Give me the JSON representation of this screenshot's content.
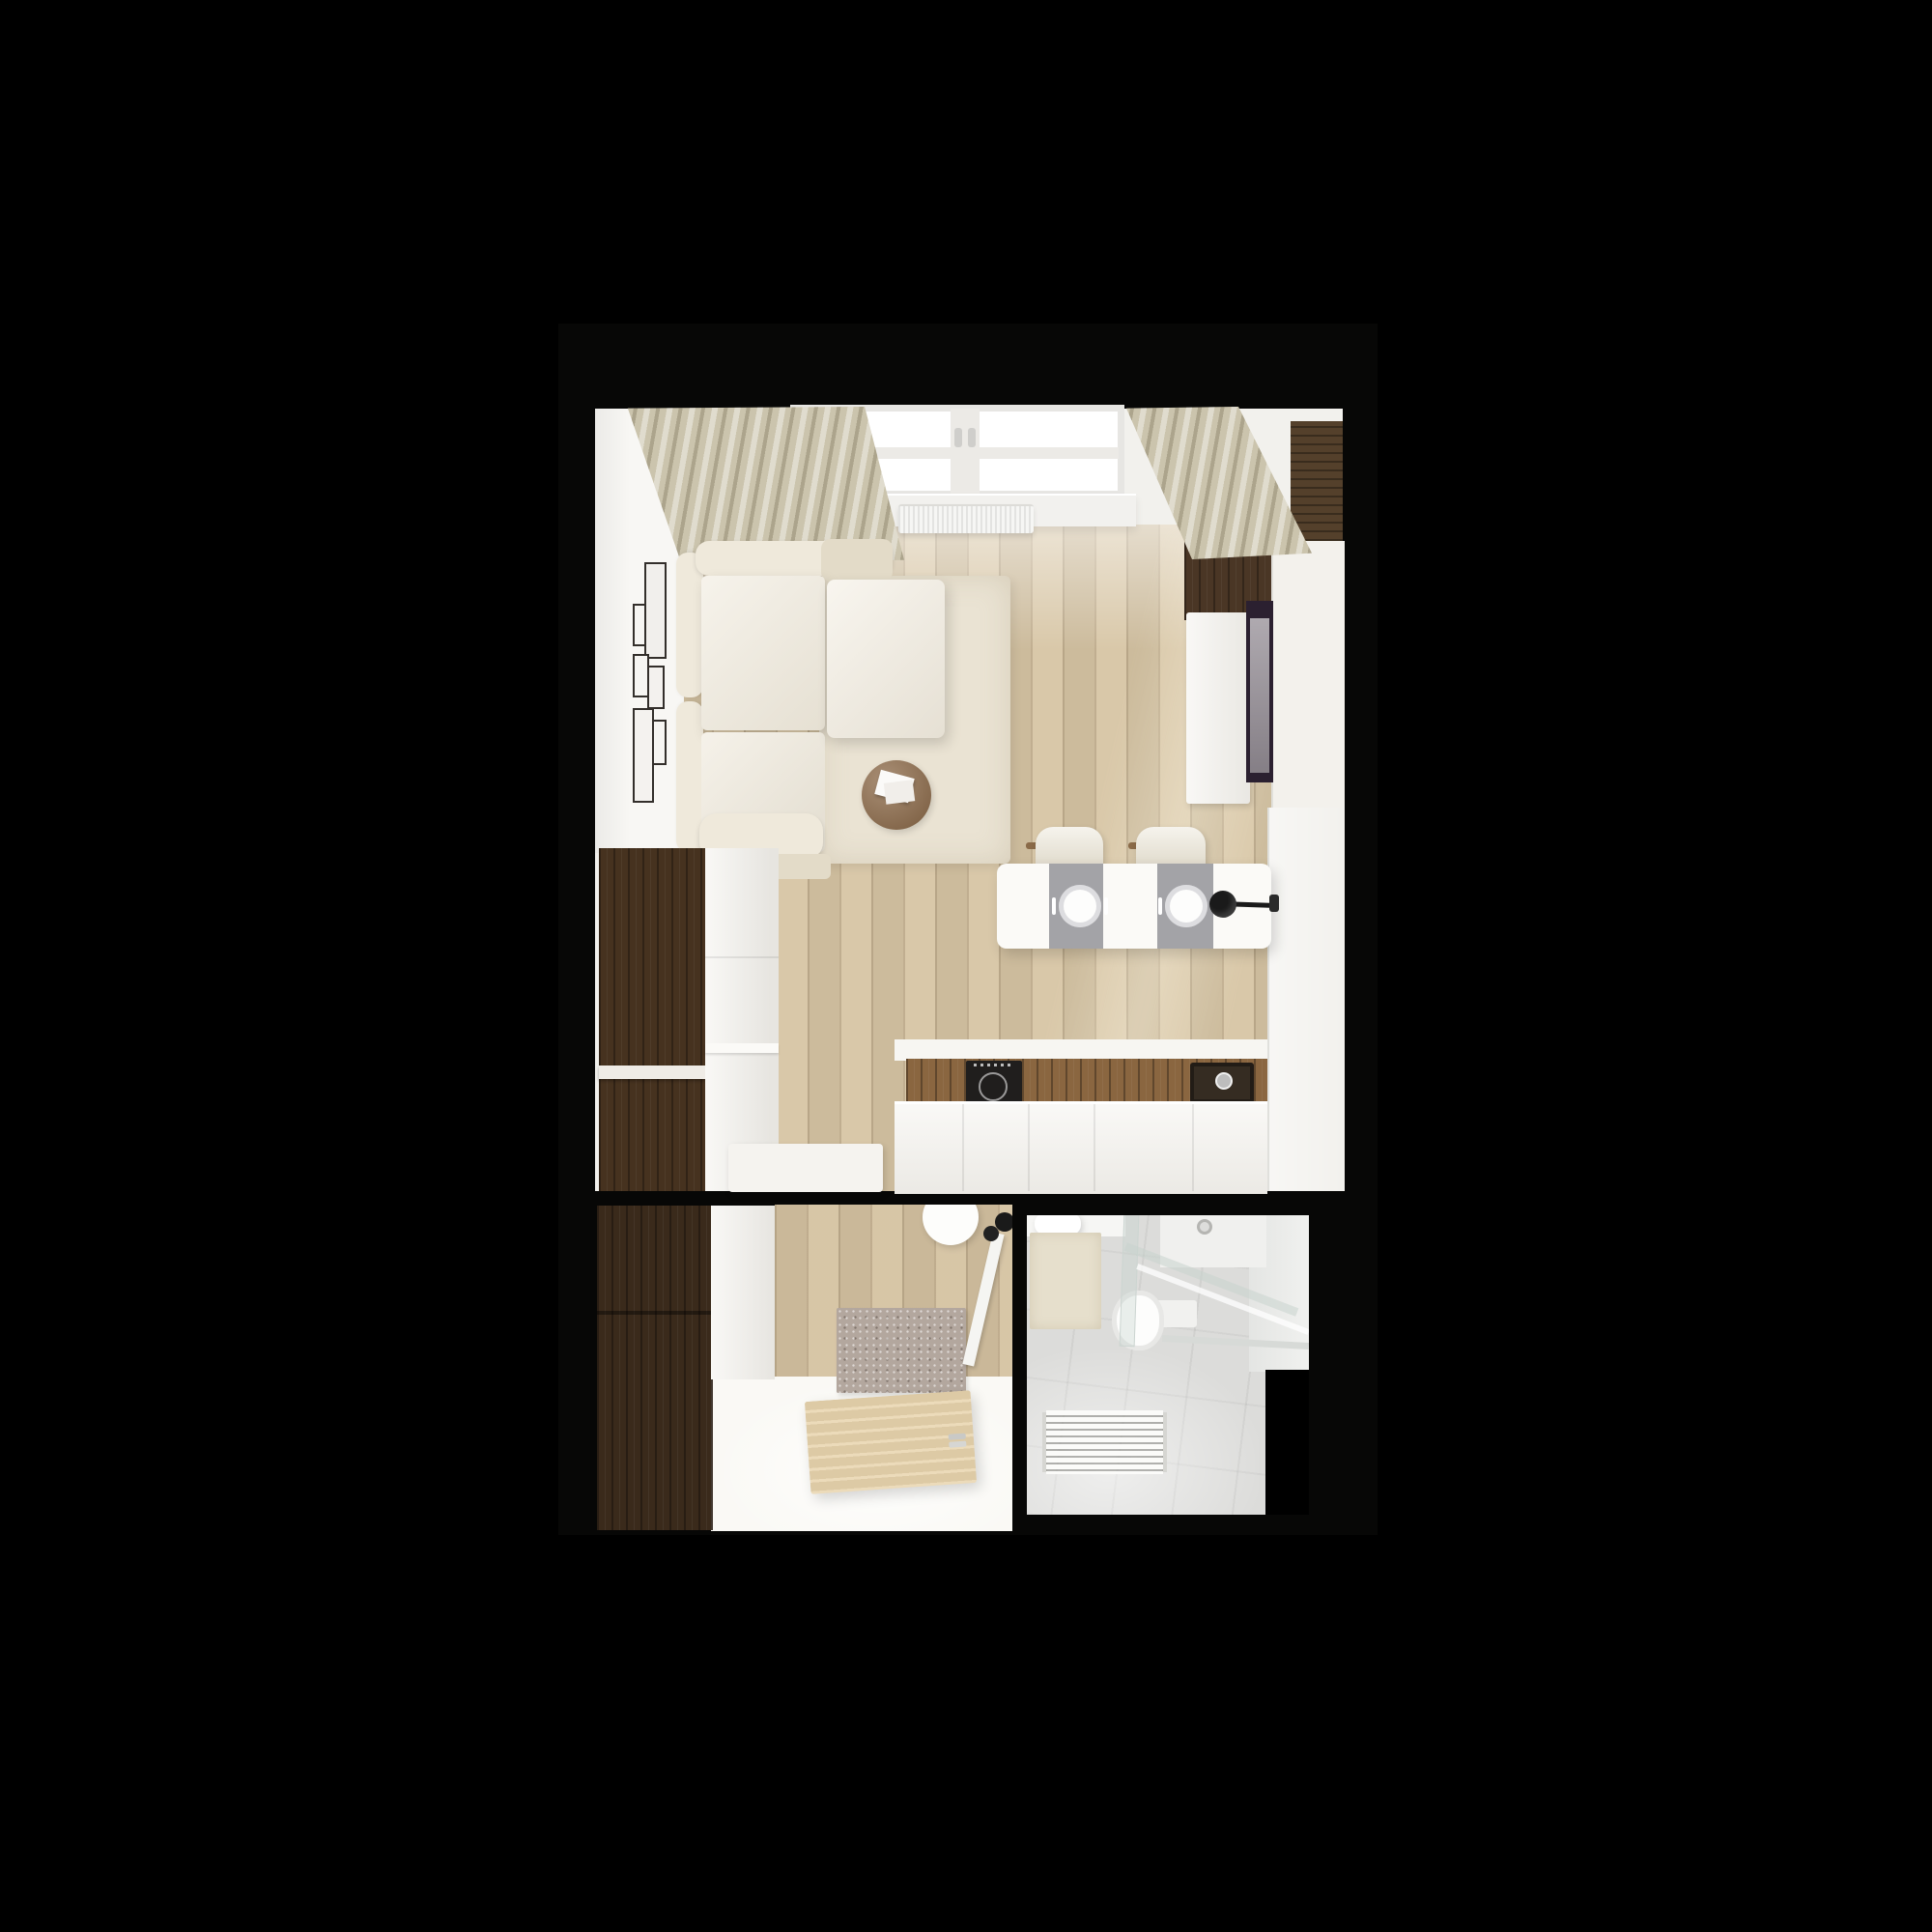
{
  "scene": {
    "description": "Photorealistic top-down 3D render of a small studio apartment on a black background",
    "rooms": [
      {
        "label": "living-room-with-kitchen",
        "items": [
          "beige curtains",
          "window with radiator",
          "gallery wall of six frames",
          "cream corner sofa with ottoman",
          "round wooden coffee table with magazines",
          "cream area rug",
          "wood slat accent wall",
          "wall mounted tv",
          "white media console",
          "white wardrobe",
          "black wall lamp",
          "dining table with two grey runners and place settings",
          "two cream dining chairs",
          "dark wood tall cabinets",
          "white tall cabinet",
          "walnut counter with induction cooktop and sink",
          "white kitchen fronts",
          "white low bench"
        ]
      },
      {
        "label": "hallway",
        "items": [
          "dark wood wardrobe",
          "white cabinet",
          "wood floor",
          "speckled doormat",
          "open entry door with handle",
          "round white pendant",
          "black wall hooks"
        ]
      },
      {
        "label": "bathroom",
        "items": [
          "vanity with sink",
          "beige bath mat",
          "toilet",
          "glass shower enclosure",
          "shower tray with drain",
          "white towel ladder radiator",
          "grey tile floor"
        ]
      }
    ]
  },
  "colors": {
    "background": "#000000",
    "frame_bg": "#070706",
    "wall": "#f2f1ed",
    "wall_bright": "#f8f7f4",
    "floor_wood": "#d7c5a4",
    "hall_wood": "#d5c2a1",
    "door_wood": "#e9d5ae",
    "counter_wood": "#8a6640",
    "cabinet_dark_wood": "#46321f",
    "wardrobe_dark_wood": "#3a2a1b",
    "slat_wood": "#54402b",
    "slat_wood_deep": "#4a3625",
    "sofa_cream": "#efe9db",
    "sofa_cream_deep": "#e3dbc8",
    "ottoman_cream": "#f2ecdf",
    "rug_cream": "#eae3d3",
    "curtain_beige": "#cbc4ad",
    "coffee_table_wood": "#8d6a48",
    "tv_screen": "#948d95",
    "tv_frame": "#2b2030",
    "white_furniture": "#f3f1ec",
    "table_white": "#fbfaf7",
    "runner_grey": "#a3a3a7",
    "chair_cream": "#e8e2d2",
    "chair_arm_wood": "#8a6a48",
    "lamp_black": "#1a1a1a",
    "cooktop_black": "#201e1d",
    "sink_dark": "#352c22",
    "doormat_grey": "#b3a79e",
    "tile_grey": "#dcdcda",
    "bath_mat_beige": "#e6dfcc",
    "fixture_white": "#f6f6f4",
    "bench_white": "#f5f3ef",
    "bright_floor": "#faf9f5"
  }
}
